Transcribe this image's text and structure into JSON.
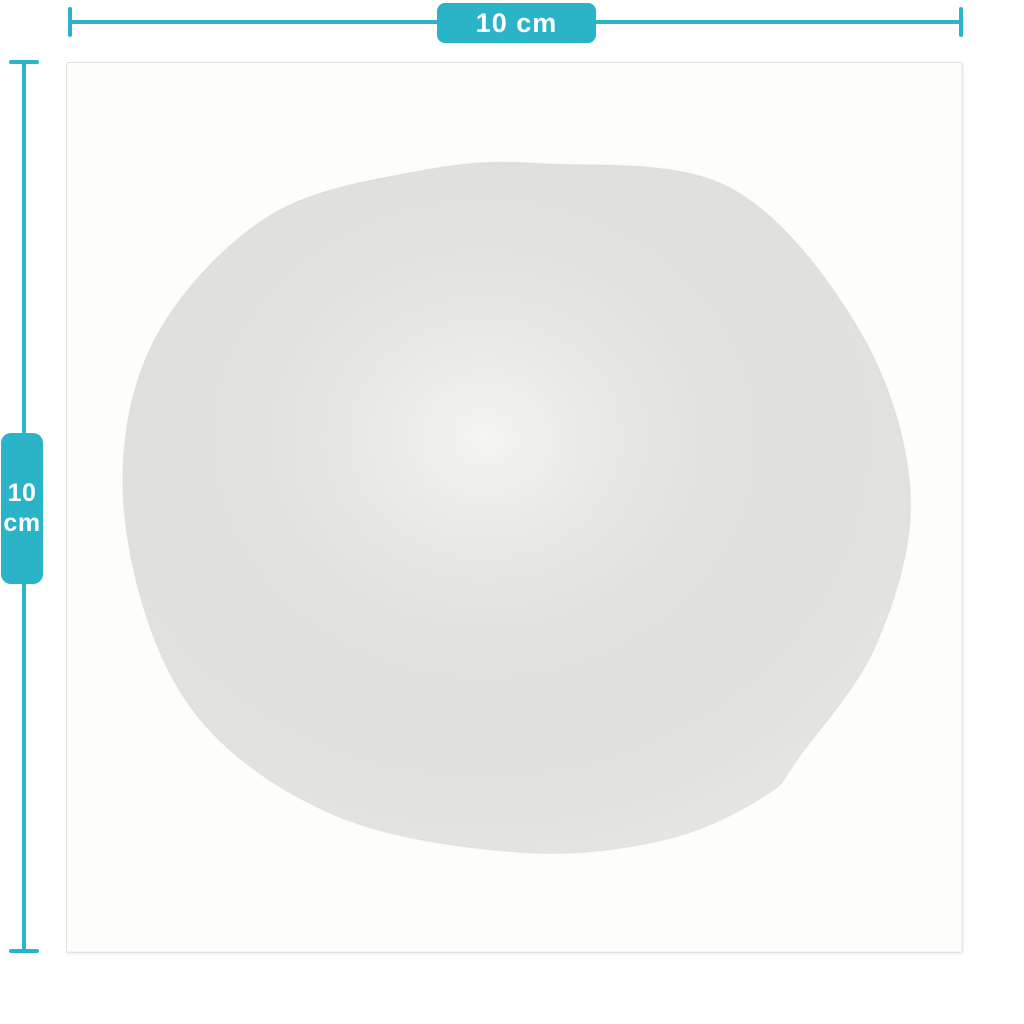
{
  "dimensions": {
    "width": {
      "label": "10 cm"
    },
    "height": {
      "value": "10",
      "unit": "cm"
    }
  },
  "colors": {
    "accent": "#2bb3c7",
    "label_text": "#ffffff",
    "page_background": "#ffffff",
    "sheet_background": "#fdfdfc",
    "sheet_border": "#e4e4e2",
    "sticker_fill": "#f1f1ef",
    "sticker_edge": "#e6e6e3"
  }
}
